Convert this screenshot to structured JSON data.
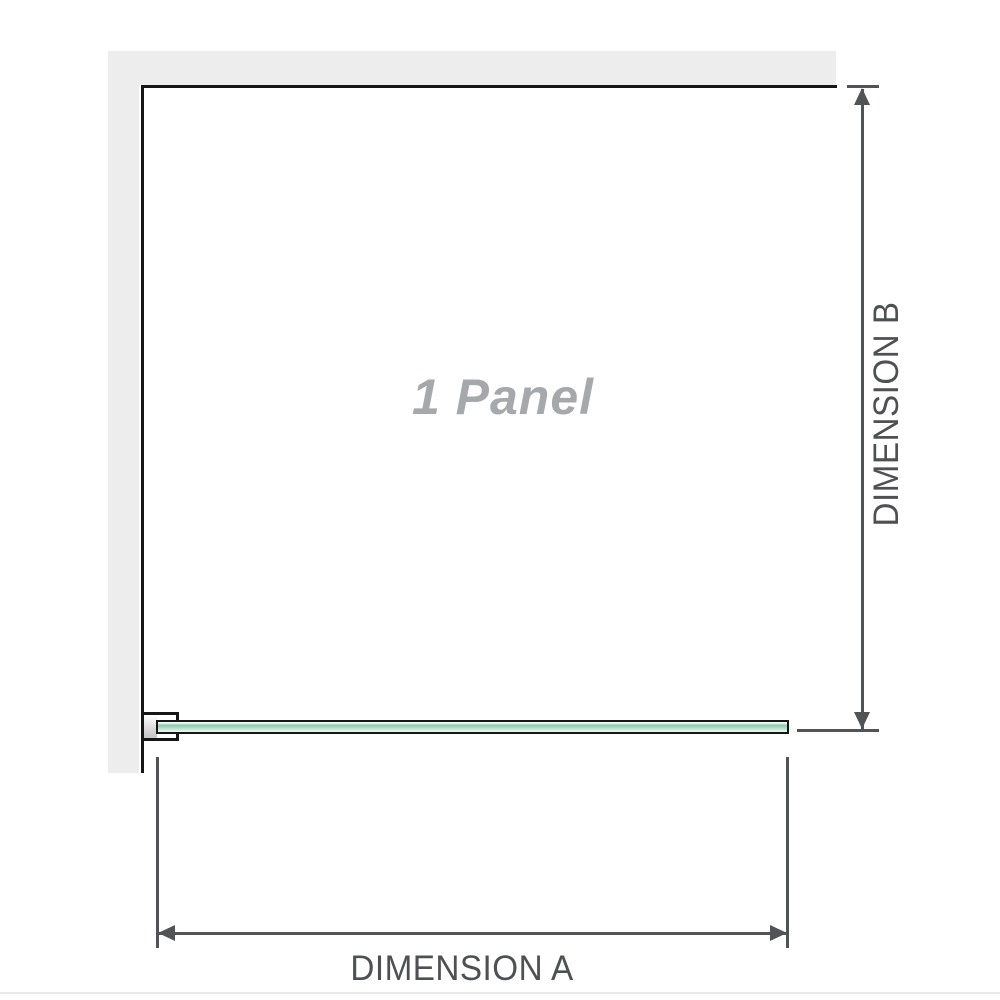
{
  "diagram": {
    "panel_label": "1 Panel",
    "dimensions": {
      "a_label": "DIMENSION A",
      "b_label": "DIMENSION B"
    },
    "colors": {
      "background": "#ffffff",
      "wall_fill": "#ededee",
      "outline": "#161616",
      "dimension_line": "#515357",
      "label_text": "#4e5053",
      "watermark_text": "#a6a8ab",
      "glass_green_dark": "#8fccae",
      "glass_green_mid": "#a3d5bc",
      "glass_green_soft": "#cfeadd",
      "glass_green_light": "#f0faf5",
      "clamp_metal": "#c8c8c8",
      "footer_rule": "#e8e8e8"
    }
  }
}
